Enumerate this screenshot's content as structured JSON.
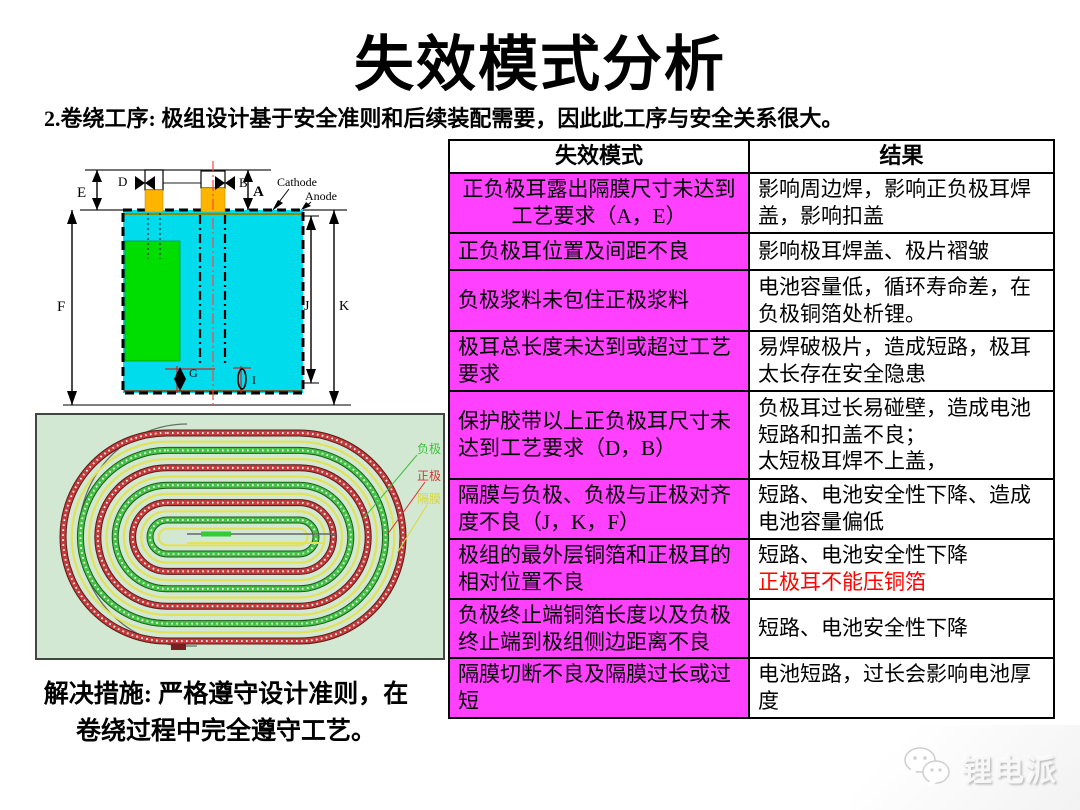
{
  "title": "失效模式分析",
  "subtitle": "2.卷绕工序: 极组设计基于安全准则和后续装配需要，因此此工序与安全关系很大。",
  "solution": {
    "line1": "解决措施: 严格遵守设计准则，在",
    "line2": "卷绕过程中完全遵守工艺。"
  },
  "battery_diagram": {
    "labels": {
      "e": "E",
      "d": "D",
      "b": "B",
      "a": "A",
      "f": "F",
      "j": "J",
      "k": "K",
      "g": "G",
      "i": "I",
      "cathode": "Cathode",
      "anode": "Anode"
    },
    "colors": {
      "body": "#00dcec",
      "coating": "#00dd00",
      "tab": "#ffb400",
      "centerline": "#ff4444"
    }
  },
  "winding_diagram": {
    "background": "#d2e8d2",
    "legend": [
      {
        "label": "负极",
        "color": "#3fc03f"
      },
      {
        "label": "正极",
        "color": "#dd3333"
      },
      {
        "label": "隔膜",
        "color": "#d8d83a"
      }
    ]
  },
  "table": {
    "headers": [
      "失效模式",
      "结果"
    ],
    "mode_bg": "#ff40ff",
    "red_text": "#ff0000",
    "rows": [
      {
        "mode": "正负极耳露出隔膜尺寸未达到工艺要求（A，E）",
        "result": "影响周边焊，影响正负极耳焊盖，影响扣盖"
      },
      {
        "mode": "正负极耳位置及间距不良",
        "result": "影响极耳焊盖、极片褶皱"
      },
      {
        "mode": "负极浆料未包住正极浆料",
        "result": "电池容量低，循环寿命差，在负极铜箔处析锂。"
      },
      {
        "mode": "极耳总长度未达到或超过工艺要求",
        "result": "易焊破极片，造成短路，极耳太长存在安全隐患"
      },
      {
        "mode": "保护胶带以上正负极耳尺寸未达到工艺要求（D，B）",
        "result": "负极耳过长易碰壁，造成电池短路和扣盖不良；",
        "result2": "太短极耳焊不上盖，"
      },
      {
        "mode": "隔膜与负极、负极与正极对齐度不良（J，K，F）",
        "result": "短路、电池安全性下降、造成电池容量偏低"
      },
      {
        "mode": "极组的最外层铜箔和正极耳的相对位置不良",
        "result": "短路、电池安全性下降",
        "result_red": "正极耳不能压铜箔"
      },
      {
        "mode": "负极终止端铜箔长度以及负极终止端到极组侧边距离不良",
        "result": "短路、电池安全性下降"
      },
      {
        "mode": "隔膜切断不良及隔膜过长或过短",
        "result": "电池短路，过长会影响电池厚度"
      }
    ]
  },
  "watermark": {
    "label": "锂电派"
  }
}
